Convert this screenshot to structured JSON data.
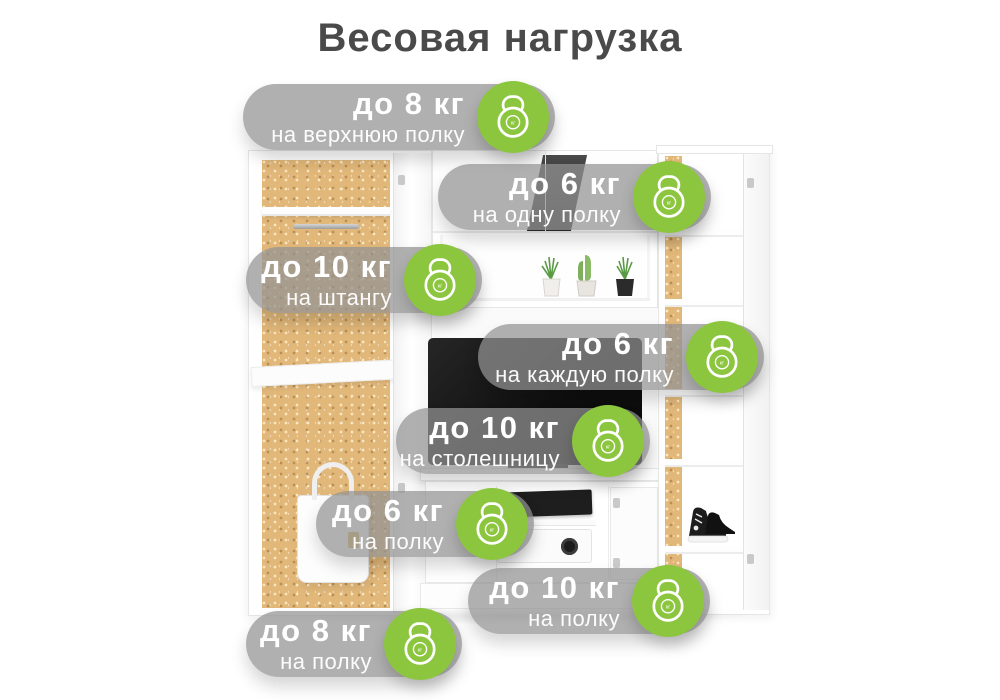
{
  "title": "Весовая нагрузка",
  "colors": {
    "accent_green": "#8CC63F",
    "badge_background": "rgba(147,147,147,0.73)",
    "badge_text": "#FFFFFF",
    "title_text": "#4A4A4A",
    "cork_panel": "#E2B87A"
  },
  "icon_label": "кг",
  "badges": [
    {
      "weight": "до 8 кг",
      "target": "на верхнюю полку"
    },
    {
      "weight": "до 6 кг",
      "target": "на одну полку"
    },
    {
      "weight": "до 10 кг",
      "target": "на штангу"
    },
    {
      "weight": "до 6 кг",
      "target": "на каждую полку"
    },
    {
      "weight": "до 10 кг",
      "target": "на столешницу"
    },
    {
      "weight": "до 6 кг",
      "target": "на полку"
    },
    {
      "weight": "до 10 кг",
      "target": "на полку"
    },
    {
      "weight": "до 8 кг",
      "target": "на полку"
    }
  ]
}
